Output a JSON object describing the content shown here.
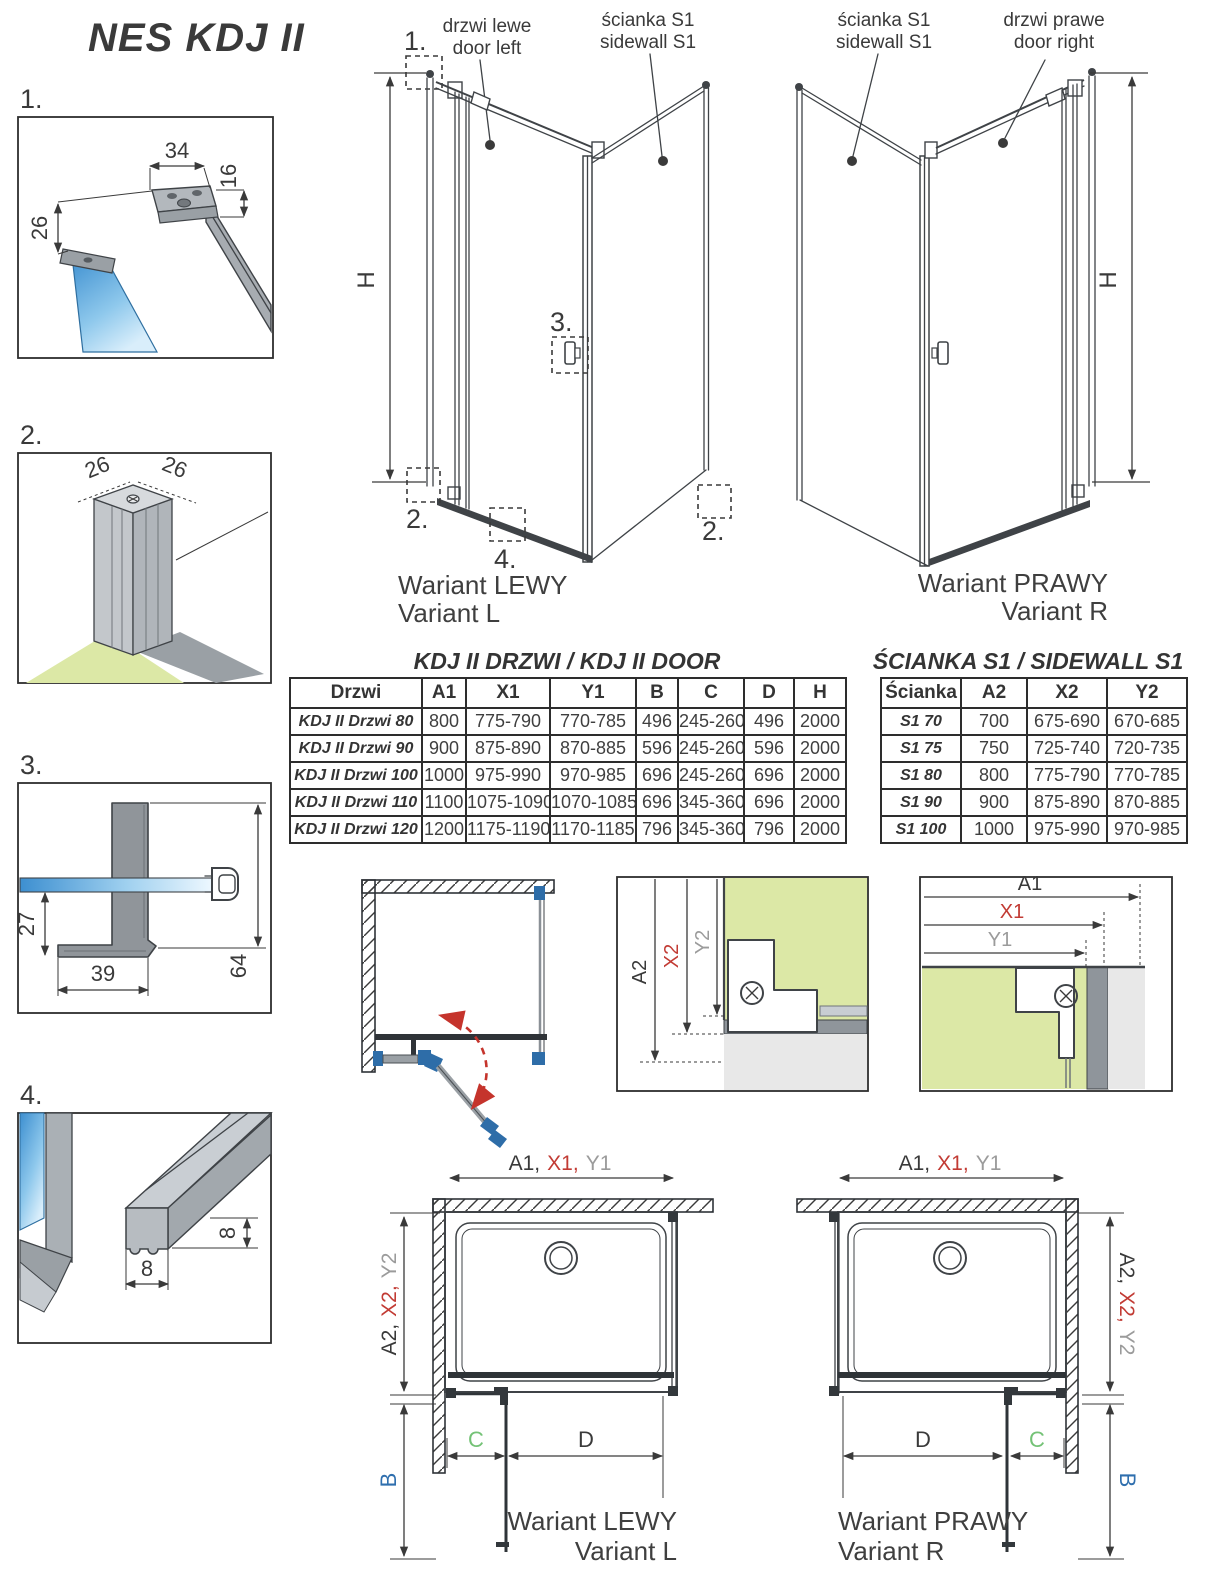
{
  "page": {
    "title": "NES KDJ II"
  },
  "callouts": {
    "n1": "1.",
    "n2": "2.",
    "n3": "3.",
    "n4": "4."
  },
  "details": {
    "d1": {
      "dim_width": "34",
      "dim_depth": "16",
      "dim_offset": "26"
    },
    "d2": {
      "dim_left": "26",
      "dim_right": "26"
    },
    "d3": {
      "dim_drop": "27",
      "dim_width": "39",
      "dim_height": "64"
    },
    "d4": {
      "dim_width": "8",
      "dim_height": "8"
    }
  },
  "variant_left": {
    "door_label_pl": "drzwi lewe",
    "door_label_en": "door left",
    "sidewall_label_pl": "ścianka S1",
    "sidewall_label_en": "sidewall S1",
    "height_label": "H",
    "caption_pl": "Wariant LEWY",
    "caption_en": "Variant L"
  },
  "variant_right": {
    "sidewall_label_pl": "ścianka S1",
    "sidewall_label_en": "sidewall S1",
    "door_label_pl": "drzwi prawe",
    "door_label_en": "door right",
    "height_label": "H",
    "caption_pl": "Wariant PRAWY",
    "caption_en": "Variant R"
  },
  "door_table": {
    "title": "KDJ II DRZWI / KDJ II DOOR",
    "headers": [
      "Drzwi",
      "A1",
      "X1",
      "Y1",
      "B",
      "C",
      "D",
      "H"
    ],
    "rows": [
      [
        "KDJ II Drzwi 80",
        "800",
        "775-790",
        "770-785",
        "496",
        "245-260",
        "496",
        "2000"
      ],
      [
        "KDJ II Drzwi 90",
        "900",
        "875-890",
        "870-885",
        "596",
        "245-260",
        "596",
        "2000"
      ],
      [
        "KDJ II Drzwi 100",
        "1000",
        "975-990",
        "970-985",
        "696",
        "245-260",
        "696",
        "2000"
      ],
      [
        "KDJ II Drzwi 110",
        "1100",
        "1075-1090",
        "1070-1085",
        "696",
        "345-360",
        "696",
        "2000"
      ],
      [
        "KDJ II Drzwi 120",
        "1200",
        "1175-1190",
        "1170-1185",
        "796",
        "345-360",
        "796",
        "2000"
      ]
    ]
  },
  "sidewall_table": {
    "title": "ŚCIANKA S1 / SIDEWALL S1",
    "headers": [
      "Ścianka",
      "A2",
      "X2",
      "Y2"
    ],
    "rows": [
      [
        "S1 70",
        "700",
        "675-690",
        "670-685"
      ],
      [
        "S1 75",
        "750",
        "725-740",
        "720-735"
      ],
      [
        "S1 80",
        "800",
        "775-790",
        "770-785"
      ],
      [
        "S1 90",
        "900",
        "875-890",
        "870-885"
      ],
      [
        "S1 100",
        "1000",
        "975-990",
        "970-985"
      ]
    ]
  },
  "mount_door": {
    "dim_a": "A1",
    "dim_x": "X1",
    "dim_y": "Y1"
  },
  "mount_sidewall": {
    "dim_a": "A2",
    "dim_x": "X2",
    "dim_y": "Y2"
  },
  "plan_left": {
    "top_a": "A1,",
    "top_x": "X1,",
    "top_y": "Y1",
    "side_a": "A2,",
    "side_x": "X2,",
    "side_y": "Y2",
    "b": "B",
    "c": "C",
    "d": "D",
    "caption_pl": "Wariant LEWY",
    "caption_en": "Variant L"
  },
  "plan_right": {
    "top_a": "A1,",
    "top_x": "X1,",
    "top_y": "Y1",
    "side_a": "A2,",
    "side_x": "X2,",
    "side_y": "Y2",
    "b": "B",
    "c": "C",
    "d": "D",
    "caption_pl": "Wariant PRAWY",
    "caption_en": "Variant R"
  },
  "colors": {
    "dim_red": "#c23b34",
    "dim_gray": "#9b9b9b",
    "dim_blue": "#2f6fae",
    "dim_green": "#74c276",
    "dim_purple": "#5b4b9e",
    "wall_green": "#dce8a6",
    "glass_blue": "#3d8fd0",
    "hinge_blue": "#2e6da8",
    "swing_arrow_red": "#c5342c",
    "line_dark": "#3a3a3a"
  }
}
